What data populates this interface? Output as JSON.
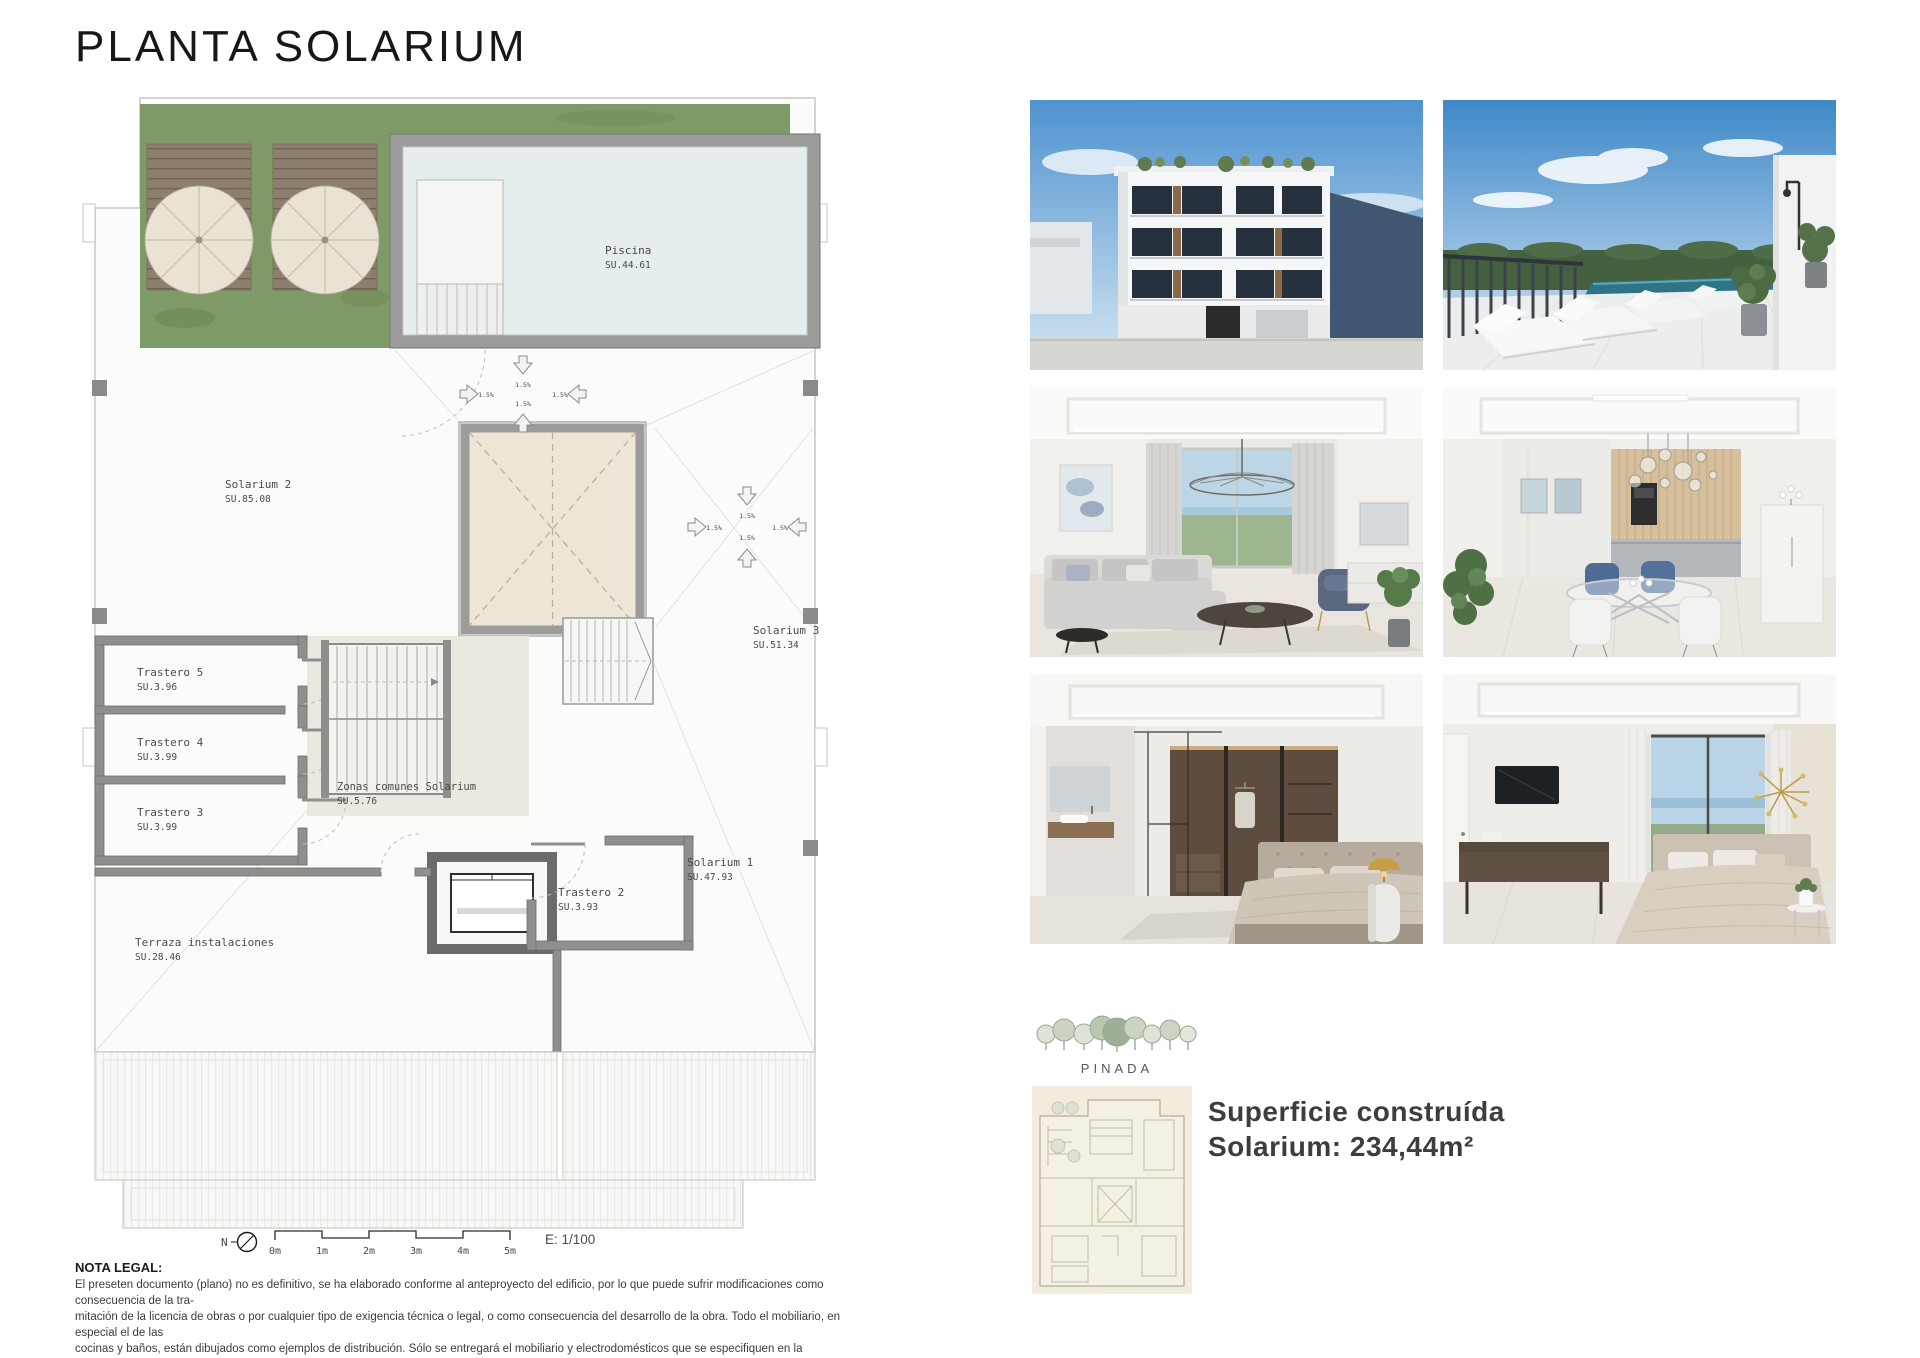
{
  "title": "PLANTA SOLARIUM",
  "plan": {
    "labels": {
      "piscina": {
        "name": "Piscina",
        "area": "SU.44.61"
      },
      "solarium2": {
        "name": "Solarium 2",
        "area": "SU.85.08"
      },
      "solarium3": {
        "name": "Solarium 3",
        "area": "SU.51.34"
      },
      "solarium1": {
        "name": "Solarium 1",
        "area": "SU.47.93"
      },
      "trastero5": {
        "name": "Trastero 5",
        "area": "SU.3.96"
      },
      "trastero4": {
        "name": "Trastero 4",
        "area": "SU.3.99"
      },
      "trastero3": {
        "name": "Trastero 3",
        "area": "SU.3.99"
      },
      "trastero2": {
        "name": "Trastero 2",
        "area": "SU.3.93"
      },
      "zonas": {
        "name": "Zonas comunes Solarium",
        "area": "SU.5.76"
      },
      "terraza": {
        "name": "Terraza instalaciones",
        "area": "SU.28.46"
      }
    },
    "slope": "1.5%",
    "north": "N",
    "scale_ticks": [
      "0m",
      "1m",
      "2m",
      "3m",
      "4m",
      "5m"
    ],
    "scale_text": "E: 1/100"
  },
  "legal": {
    "heading": "NOTA LEGAL:",
    "lines": [
      "El preseten documento (plano) no es definitivo, se ha elaborado conforme al anteproyecto del edificio, por lo que puede sufrir modificaciones como consecuencia de la tra-",
      "mitación de la licencia de obras o por cualquier tipo de exigencia técnica o legal, o como consecuencia del desarrollo de la obra. Todo el mobiliario, en especial el de las",
      "cocinas y baños, están dibujados como ejemplos de distribución. Sólo se entregará el mobiliario y electrodomésticos que se especifiquen en la memoria comercial definitiva.",
      "Es un plano meramente informativo, sin contenido contractual."
    ]
  },
  "brand": "PINADA",
  "summary": {
    "line1": "Superficie construída",
    "line2": "Solarium: 234,44m²"
  },
  "colors": {
    "garden_green": "#7e9a66",
    "wall_gray": "#8f8f8d",
    "skylight_beige": "#ede5d6",
    "pool_water": "#e6edee"
  }
}
